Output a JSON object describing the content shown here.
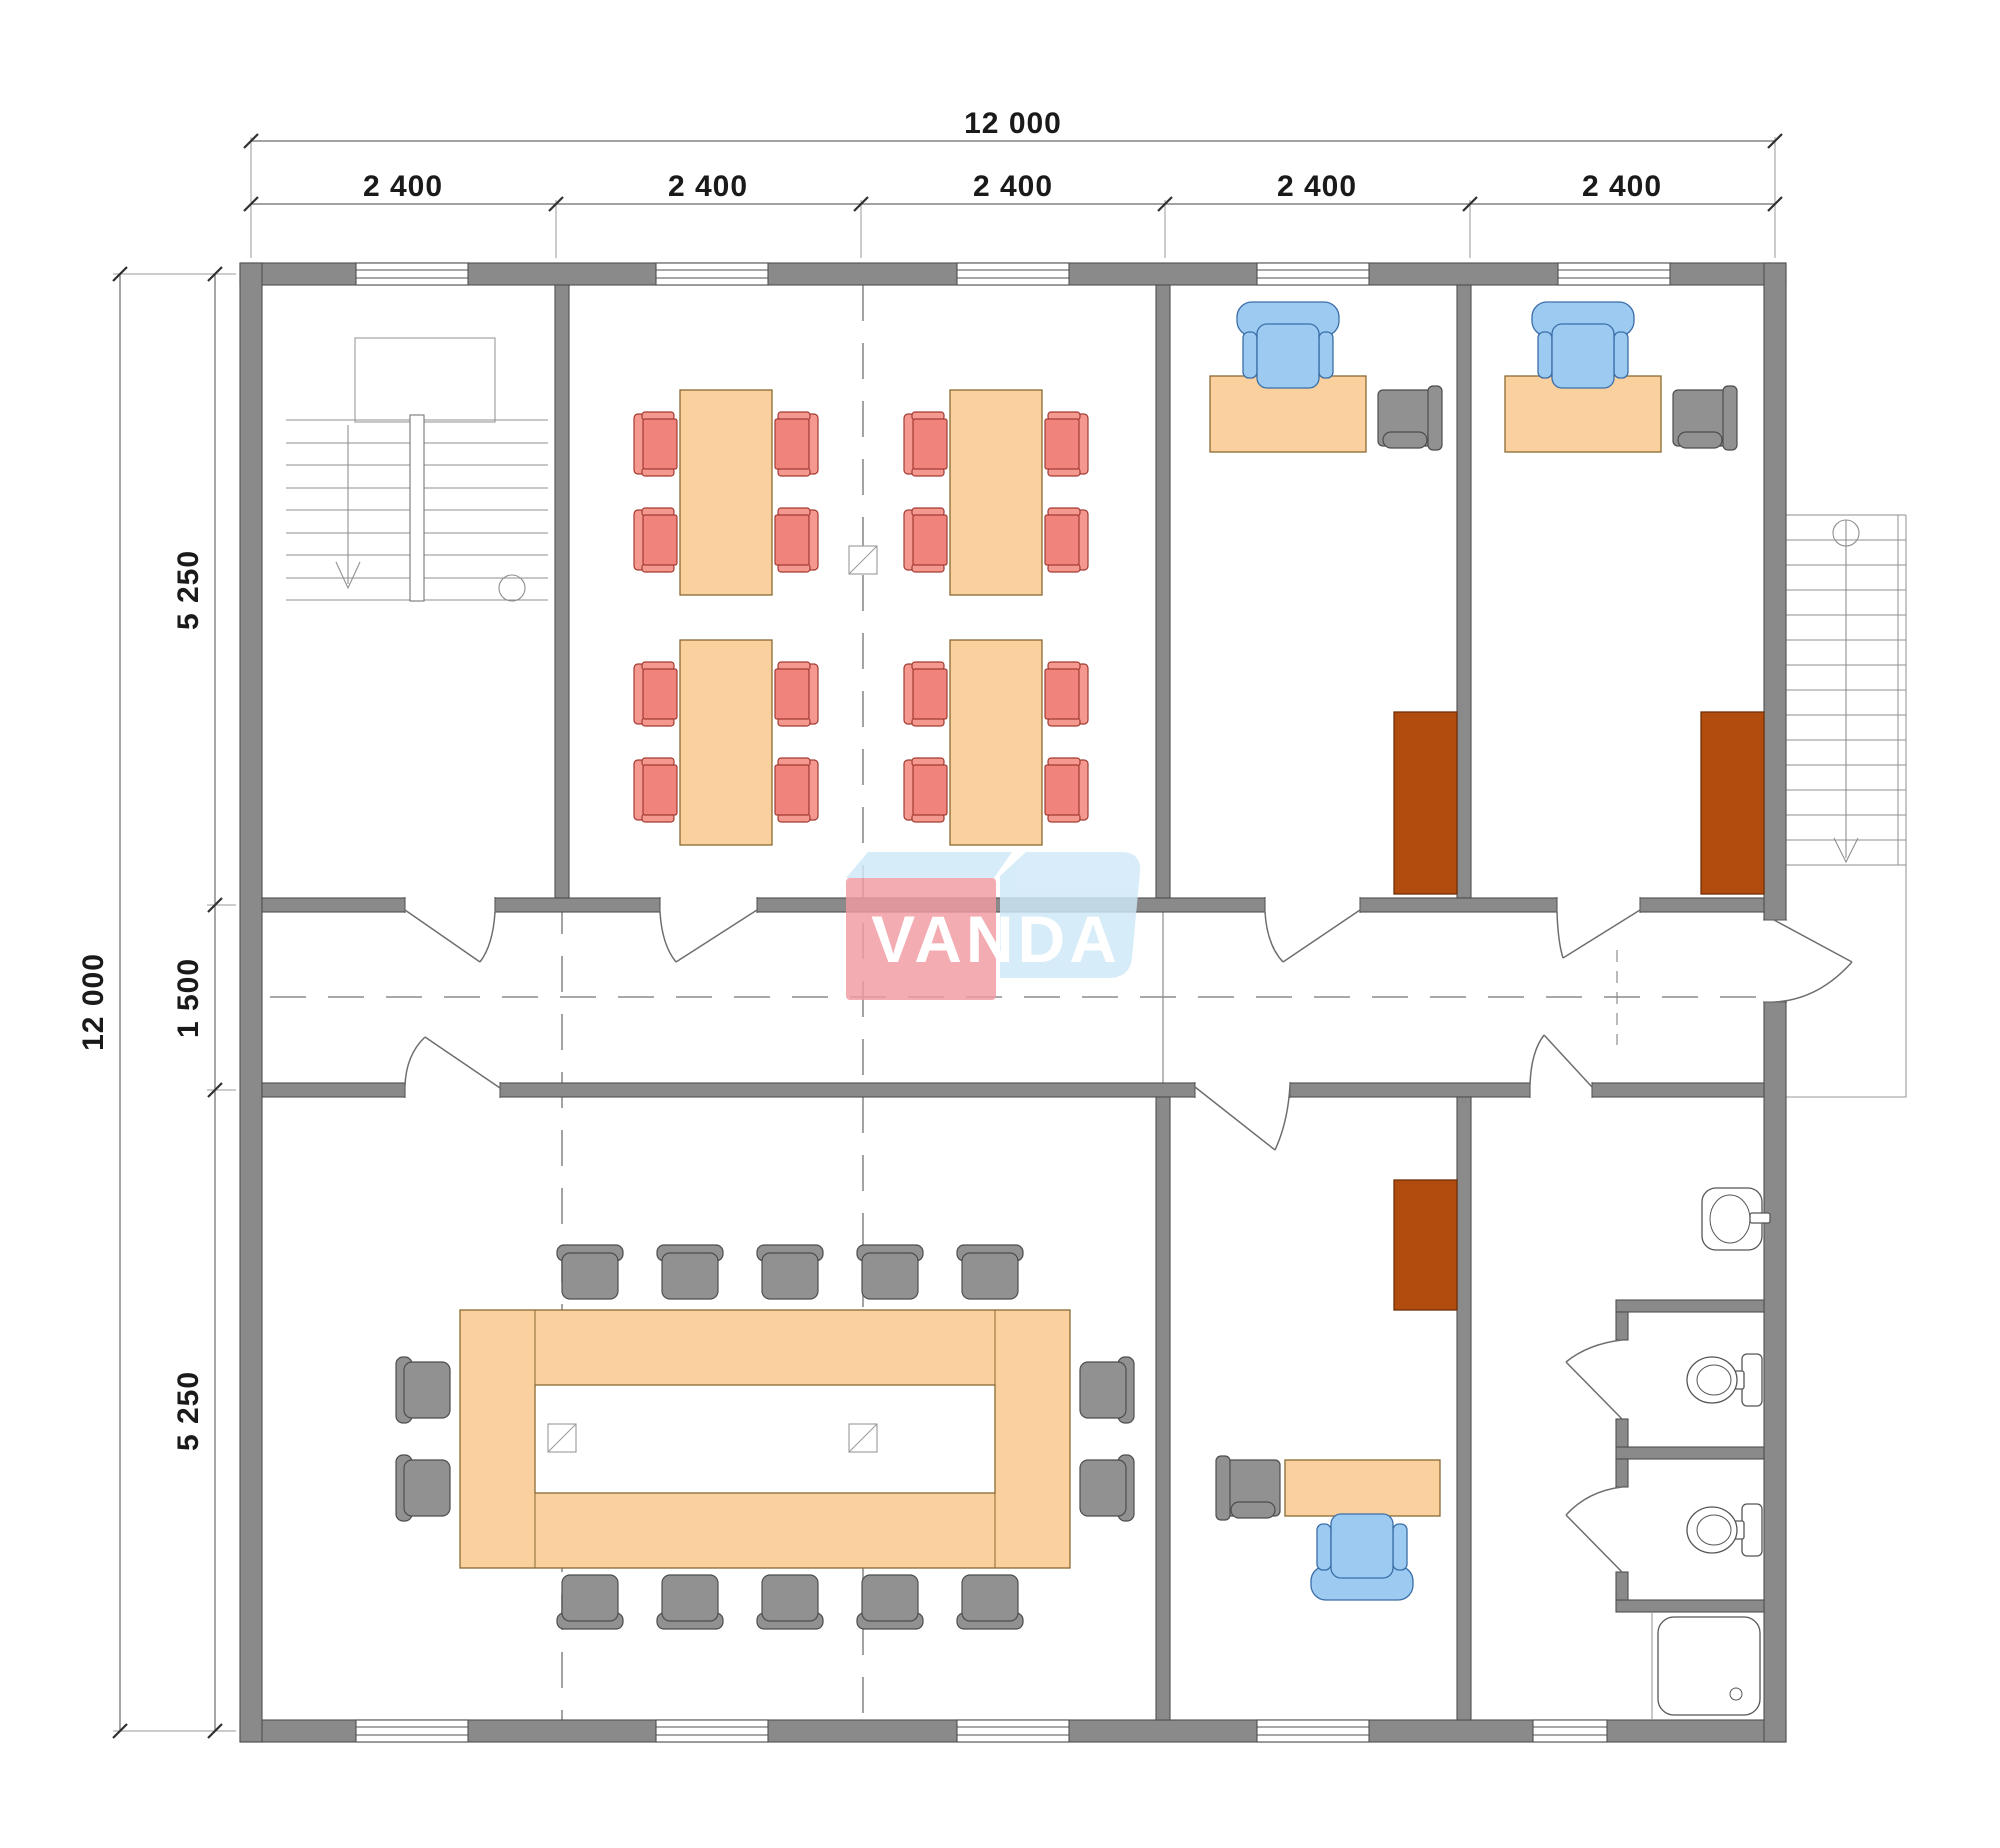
{
  "drawing": {
    "type": "architectural-floor-plan",
    "logo": {
      "text": "VANDA"
    },
    "dimensions": {
      "top": {
        "total": "12 000",
        "segments": [
          "2 400",
          "2 400",
          "2 400",
          "2 400",
          "2 400"
        ]
      },
      "left": {
        "total": "12 000",
        "segments": [
          "5 250",
          "1 500",
          "5 250"
        ]
      }
    },
    "colors": {
      "wall": "#8a8a8a",
      "table": "#f9d09e",
      "chair_red": "#f0837b",
      "chair_red_light": "#f5988f",
      "chair_blue": "#9ccaf1",
      "chair_gray": "#919191",
      "cabinet": "#b24b0e",
      "logo_red": "#f29ba3",
      "logo_blue": "#cfe9f8"
    }
  }
}
